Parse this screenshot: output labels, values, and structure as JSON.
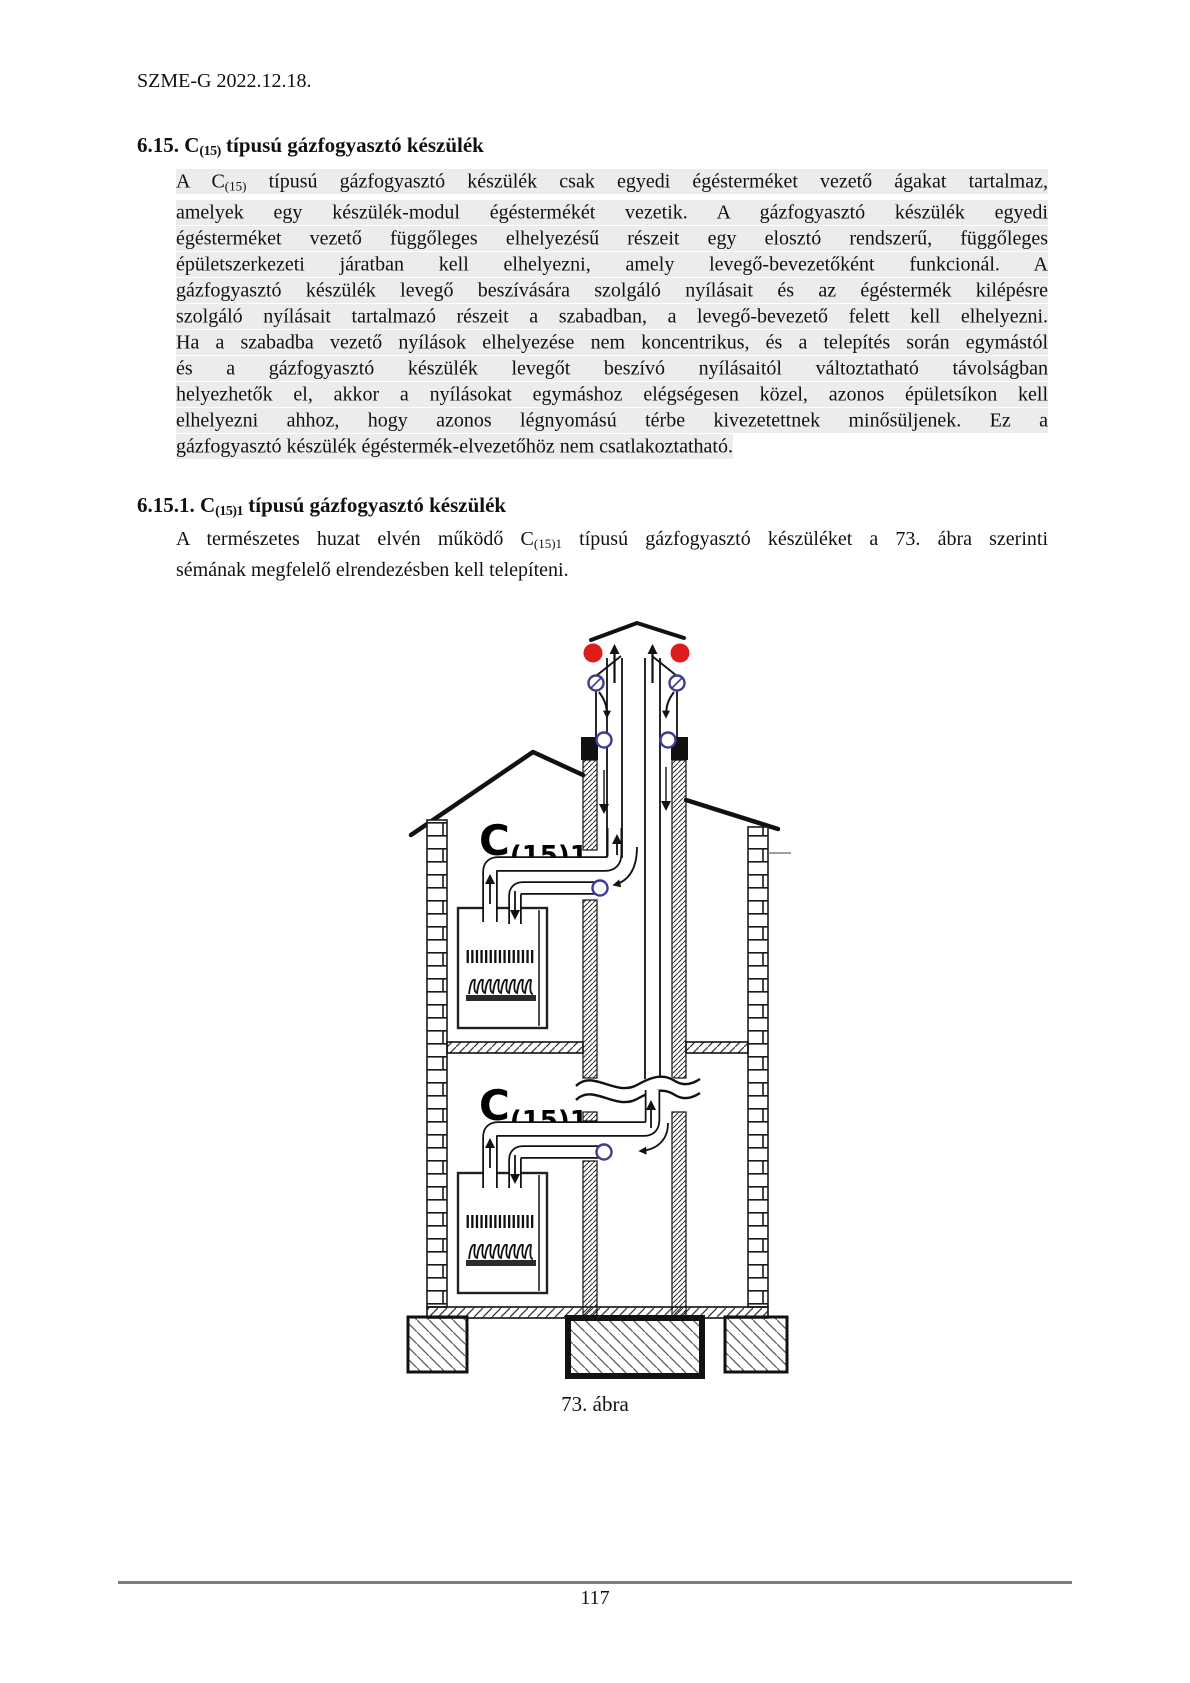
{
  "header": {
    "doc_id": "SZME-G 2022.12.18."
  },
  "section1": {
    "heading": {
      "num": "6.15.",
      "c": " C",
      "sub": "(15)",
      "rest": " típusú gázfogyasztó készülék"
    },
    "p_first": {
      "pre": "A C",
      "sub": "(15)",
      "post": " típusú gázfogyasztó készülék csak egyedi égésterméket vezető ágakat tartalmaz,"
    },
    "p_lines": [
      "amelyek egy készülék-modul égéstermékét vezetik. A gázfogyasztó készülék egyedi",
      "égésterméket vezető függőleges elhelyezésű részeit egy elosztó rendszerű, függőleges",
      "épületszerkezeti járatban kell elhelyezni, amely levegő-bevezetőként funkcionál. A",
      "gázfogyasztó készülék levegő beszívására szolgáló nyílásait és az égéstermék kilépésre",
      "szolgáló nyílásait tartalmazó részeit a szabadban, a levegő-bevezető felett kell elhelyezni.",
      "Ha a szabadba vezető nyílások elhelyezése nem koncentrikus, és a telepítés során egymástól",
      "és a gázfogyasztó készülék levegőt beszívó nyílásaitól változtatható távolságban",
      "helyezhetők el, akkor a nyílásokat egymáshoz elégségesen közel, azonos épületsíkon kell",
      "elhelyezni ahhoz, hogy azonos légnyomású térbe kivezetettnek minősüljenek. Ez a",
      "gázfogyasztó készülék égéstermék-elvezetőhöz nem csatlakoztatható."
    ]
  },
  "section2": {
    "heading": {
      "num": "6.15.1.",
      "c": " C",
      "sub": "(15)1",
      "rest": " típusú gázfogyasztó készülék"
    },
    "p_first": {
      "pre": "A természetes huzat elvén működő C",
      "sub": "(15)1",
      "post": " típusú gázfogyasztó készüléket a 73. ábra szerinti"
    },
    "p_last": "sémának megfelelő elrendezésben kell telepíteni."
  },
  "figure": {
    "caption": "73. ábra",
    "appliance_label": {
      "c": "C",
      "sub": "(15)1"
    },
    "colors": {
      "flue_outlet_red": "#dd1c1c",
      "opening_blue": "#3d3d8f",
      "highlight_gray": "#ececec"
    }
  },
  "footer": {
    "page_number": "117"
  }
}
